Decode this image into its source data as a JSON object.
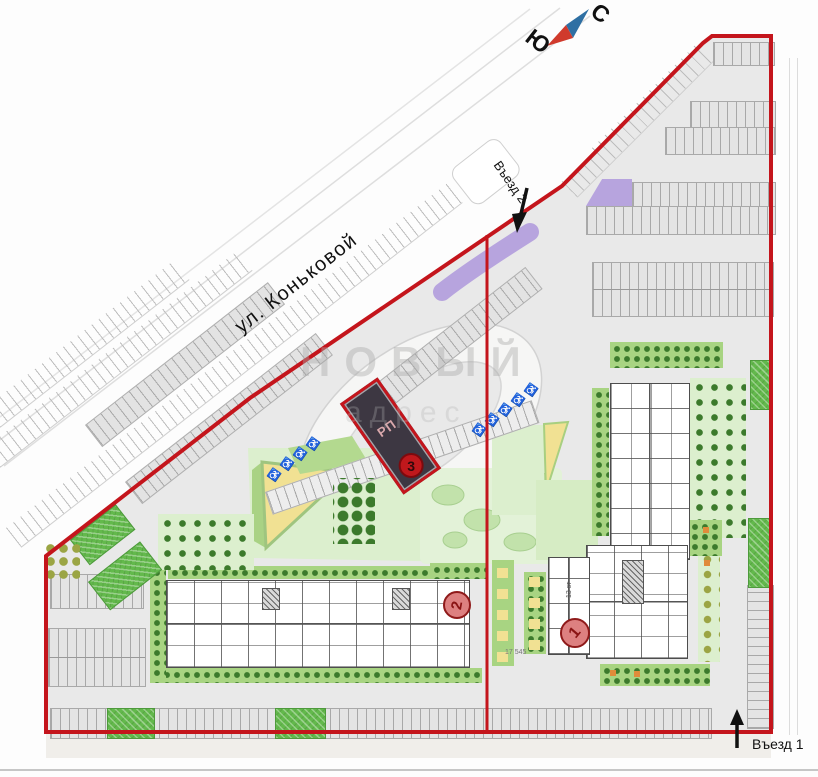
{
  "compass": {
    "north_label": "С",
    "south_label": "Ю"
  },
  "street": {
    "label": "ул. Коньковой"
  },
  "entrances": {
    "entrance_1": "Въезд 1",
    "entrance_2": "Въезд 2"
  },
  "buildings": {
    "building_1_badge": "1",
    "building_2_badge": "2",
    "transformer_badge": "3",
    "transformer_label": "РП",
    "building_1_floors": "13 эт"
  },
  "dimensions": {
    "courtyard_width": "17 545"
  },
  "watermark": {
    "line1": "НОВЫЙ",
    "line2": "адрес"
  },
  "accessible_parking_symbol": "♿",
  "colors": {
    "boundary_red": "#c4151c",
    "eco_green": "#63b94c",
    "strip_green": "#a8d482",
    "light_green": "#dcefce",
    "pale_green": "#e3f2d8",
    "blob_green": "#c2e2ab",
    "yellow": "#f1e193",
    "purple": "#b7a4de",
    "dark_tree": "#3c7a2c",
    "olive_tree": "#9ba544",
    "site_gray": "#e9e9e9",
    "building_dark": "#3d3742",
    "badge_fill": "#dd8080",
    "badge_border": "#8f1a1a",
    "compass_blue": "#2e6fa3",
    "compass_red": "#d03a2c",
    "orange": "#e08b3a"
  }
}
